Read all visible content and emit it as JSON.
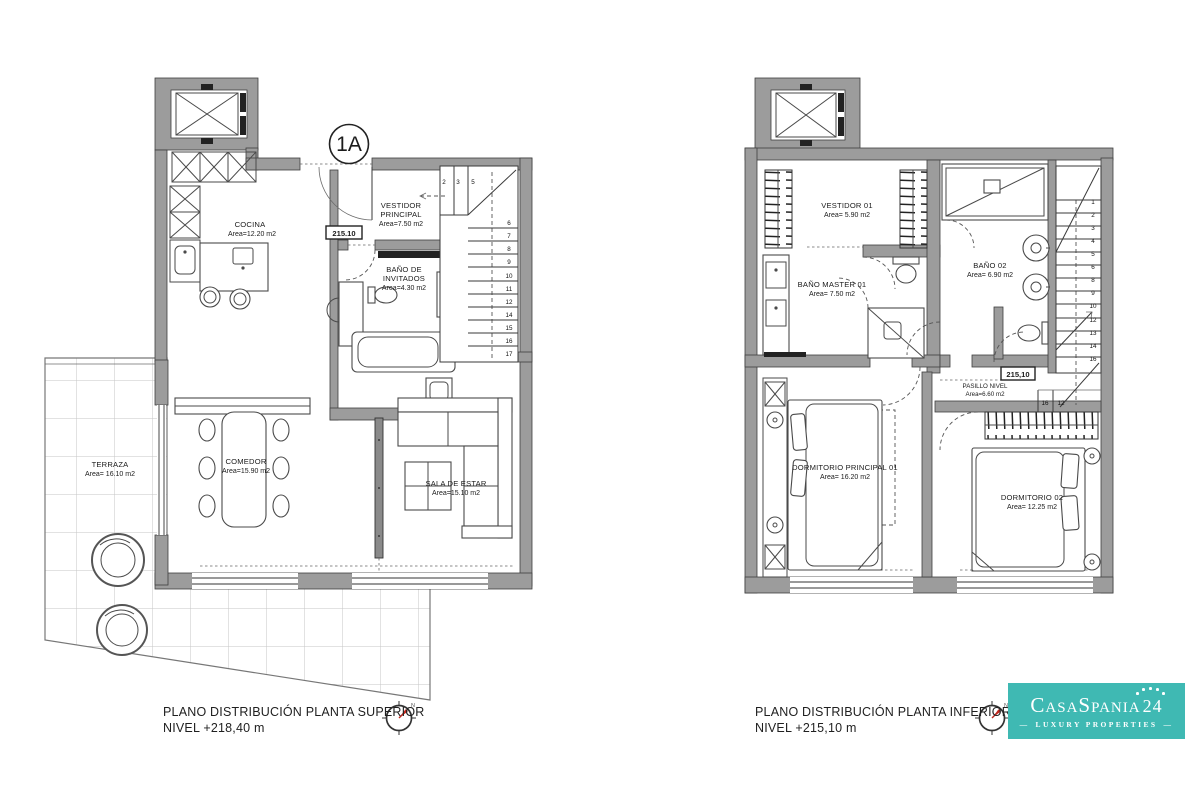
{
  "document": {
    "unit_badge": "1A",
    "compass_north": "N"
  },
  "plan_superior": {
    "caption": {
      "line1": "PLANO DISTRIBUCIÓN PLANTA SUPERIOR",
      "line2": "NIVEL +218,40 m"
    },
    "elevation_marker": "215.10",
    "rooms": {
      "cocina": {
        "name": "COCINA",
        "area": "Area=12.20 m2"
      },
      "vestidor_principal": {
        "name1": "VESTIDOR",
        "name2": "PRINCIPAL",
        "area": "Area=7.50 m2"
      },
      "banyo_invitados": {
        "name1": "BAÑO DE",
        "name2": "INVITADOS",
        "area": "Area=4.30 m2"
      },
      "comedor": {
        "name": "COMEDOR",
        "area": "Area=15.90 m2"
      },
      "sala_de_estar": {
        "name": "SALA DE ESTAR",
        "area": "Area=15.10 m2"
      },
      "terraza": {
        "name": "TERRAZA",
        "area": "Area= 16.10 m2"
      }
    },
    "stairs": {
      "landing_numbers": [
        "2",
        "3",
        "5"
      ],
      "step_numbers": [
        "6",
        "7",
        "8",
        "9",
        "10",
        "11",
        "12",
        "14",
        "15",
        "16",
        "17"
      ]
    }
  },
  "plan_inferior": {
    "caption": {
      "line1": "PLANO DISTRIBUCIÓN PLANTA INFERIOR",
      "line2": "NIVEL +215,10 m"
    },
    "elevation_marker": "215,10",
    "rooms": {
      "vestidor_01": {
        "name": "VESTIDOR 01",
        "area": "Area= 5.90 m2"
      },
      "banyo_master_01": {
        "name": "BAÑO MASTER 01",
        "area": "Area= 7.50 m2"
      },
      "banyo_02": {
        "name": "BAÑO 02",
        "area": "Area= 6.90 m2"
      },
      "pasillo": {
        "name": "PASILLO NIVEL",
        "area": "Area=6.60 m2"
      },
      "dormitorio_principal_01": {
        "name": "DORMITORIO PRINCIPAL 01",
        "area": "Area= 16.20 m2"
      },
      "dormitorio_02": {
        "name": "DORMITORIO 02",
        "area": "Area= 12.25 m2"
      }
    },
    "stairs": {
      "step_numbers": [
        "1",
        "2",
        "3",
        "4",
        "5",
        "6",
        "8",
        "9",
        "10",
        "12",
        "13",
        "14",
        "16"
      ],
      "landing_numbers": [
        "16",
        "12"
      ]
    }
  },
  "logo": {
    "brand_main": "CasaSpania",
    "brand_number": "24",
    "tagline": "LUXURY PROPERTIES",
    "dash": "—"
  },
  "colors": {
    "accent_teal": "#3FB9B3",
    "compass_red": "#C0281E",
    "wall_gray": "#9C9C9C"
  }
}
